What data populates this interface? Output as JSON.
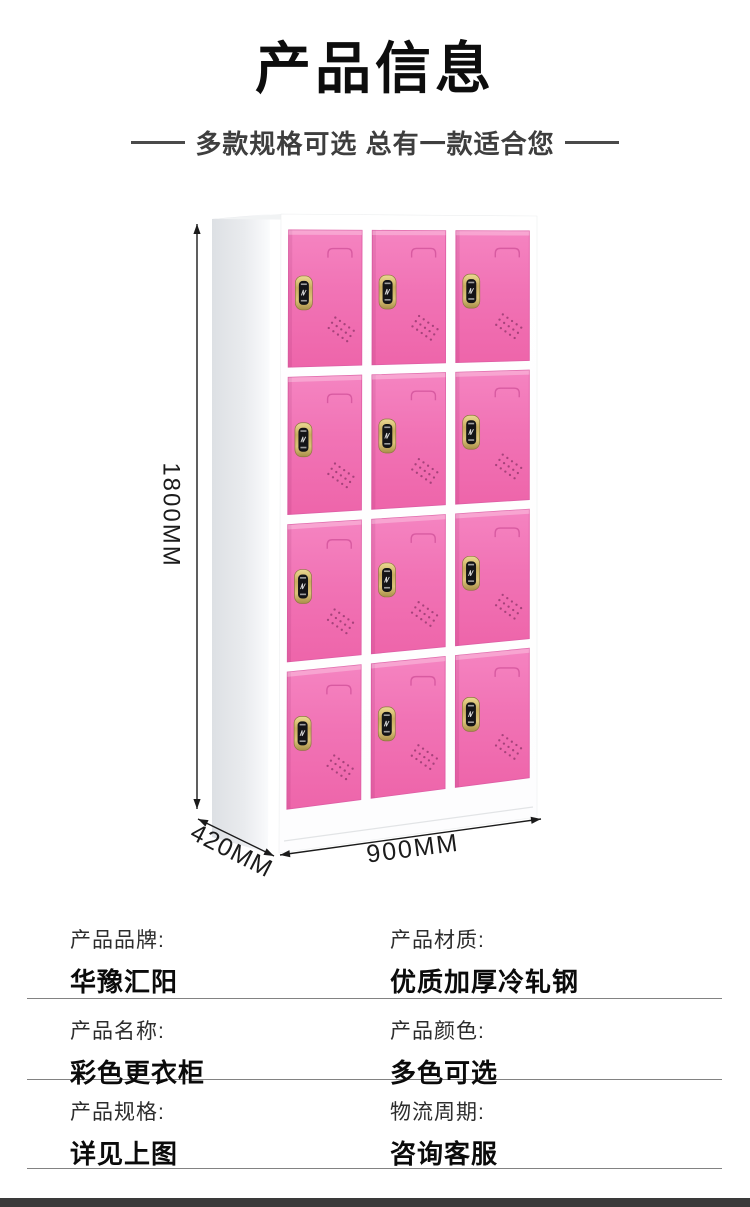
{
  "page": {
    "title": "产品信息",
    "subtitle": "多款规格可选 总有一款适合您"
  },
  "illustration": {
    "dim_height_label": "1800MM",
    "dim_depth_label": "420MM",
    "dim_width_label": "900MM",
    "grid_columns": 3,
    "grid_rows": 4,
    "door_color": "#f173b5",
    "door_color_light": "#f584c1",
    "door_color_dark": "#ee65aa",
    "door_edge_color": "#e05ea6",
    "handle_line_color": "#cf4f98",
    "lock_gold_light": "#ecd993",
    "lock_gold_mid": "#c9ad5f",
    "lock_gold_dark": "#a98f48",
    "lock_face_color": "#141417",
    "vent_dot_color": "#8e3468",
    "cabinet_white": "#fdfdfe",
    "cabinet_shade": "#f1f3f4",
    "side_panel_dark": "#dde0e4",
    "side_panel_light": "#f6f7f9",
    "dimension_color": "#1b1b1b"
  },
  "spec_table": {
    "rows": [
      {
        "left": {
          "label": "产品品牌:",
          "value": "华豫汇阳"
        },
        "right": {
          "label": "产品材质:",
          "value": "优质加厚冷轧钢"
        }
      },
      {
        "left": {
          "label": "产品名称:",
          "value": "彩色更衣柜"
        },
        "right": {
          "label": "产品颜色:",
          "value": "多色可选"
        }
      },
      {
        "left": {
          "label": "产品规格:",
          "value": "详见上图"
        },
        "right": {
          "label": "物流周期:",
          "value": "咨询客服"
        }
      }
    ]
  },
  "footer": {
    "bar_color": "#3a3a3a"
  }
}
